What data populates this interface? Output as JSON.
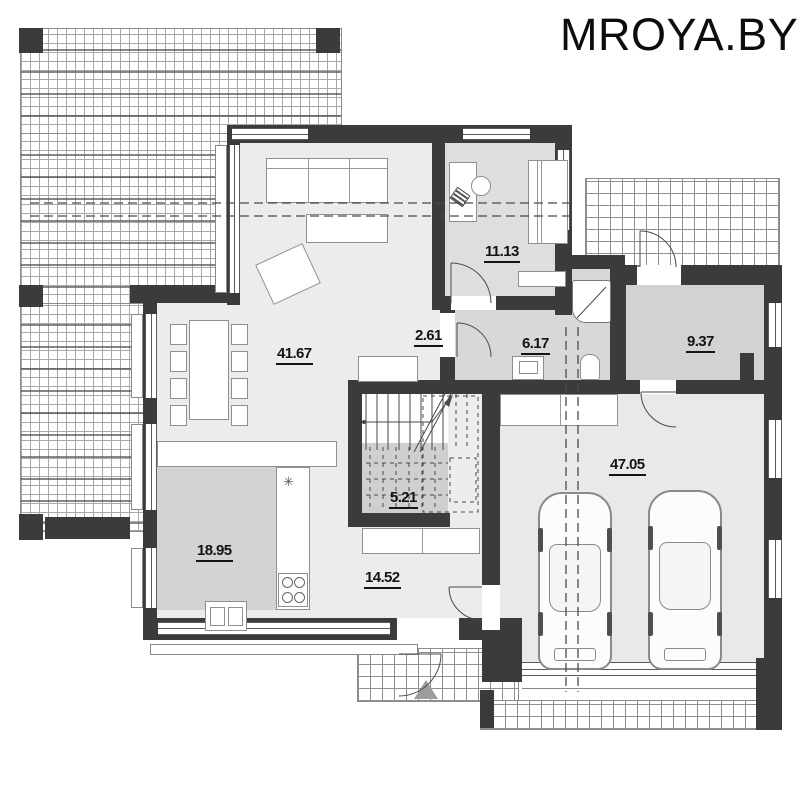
{
  "watermark": "MROYA.BY",
  "rooms": [
    {
      "name": "living-room",
      "area": "41.67"
    },
    {
      "name": "office",
      "area": "11.13"
    },
    {
      "name": "hall",
      "area": "2.61"
    },
    {
      "name": "bathroom",
      "area": "6.17"
    },
    {
      "name": "utility-room",
      "area": "9.37"
    },
    {
      "name": "pantry",
      "area": "5.21"
    },
    {
      "name": "kitchen",
      "area": "18.95"
    },
    {
      "name": "hallway",
      "area": "14.52"
    },
    {
      "name": "garage",
      "area": "47.05"
    }
  ],
  "symbols": {
    "extractor": "✳"
  },
  "colors": {
    "wall": "#3b3b3b",
    "floor_light": "#ececec",
    "floor_mid": "#d8d8d8",
    "floor_dark": "#cfcfcf",
    "line": "#4a4a4a",
    "entrance_arrow": "#9c9c9c"
  }
}
